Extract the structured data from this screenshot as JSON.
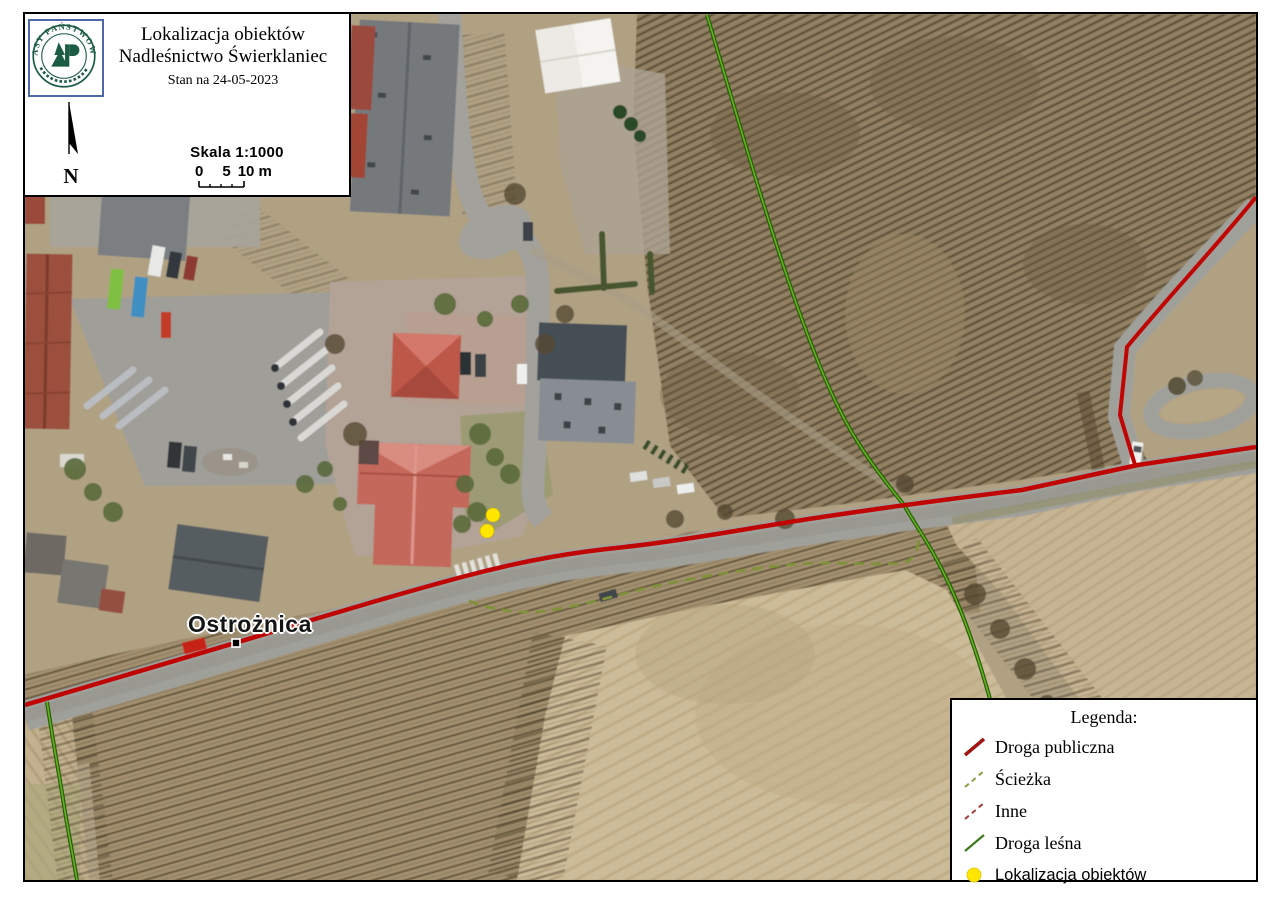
{
  "header": {
    "title_line1": "Lokalizacja obiektów",
    "title_line2": "Nadleśnictwo Świerklaniec",
    "date_line": "Stan na 24-05-2023",
    "logo_ring_text": "LASY PAŃSTWOWE",
    "north_label": "N",
    "scale_label": "Skala 1:1000",
    "scale_tick_0": "0",
    "scale_tick_5": "5",
    "scale_tick_10": "10 m"
  },
  "legend": {
    "title": "Legenda:",
    "items": [
      {
        "label": "Droga publiczna",
        "type": "solid-line",
        "color": "#a01414"
      },
      {
        "label": "Ścieżka",
        "type": "dashed-line",
        "color": "#8f9c42"
      },
      {
        "label": "Inne",
        "type": "dashed-line",
        "color": "#a63b35"
      },
      {
        "label": "Droga leśna",
        "type": "solid-line",
        "color": "#3f7a1c"
      },
      {
        "label": "Lokalizacja obiektów",
        "type": "point",
        "color": "#ffe600"
      }
    ]
  },
  "map": {
    "place_label": "Ostrożnica",
    "marker_color": "#ffe600",
    "public_road_color": "#c00505",
    "forest_road_color": "#2a5c0a",
    "forest_road_core_color": "#63b222",
    "path_color": "#7e9338",
    "object_markers_px": [
      [
        491,
        513
      ],
      [
        485,
        529
      ]
    ]
  }
}
